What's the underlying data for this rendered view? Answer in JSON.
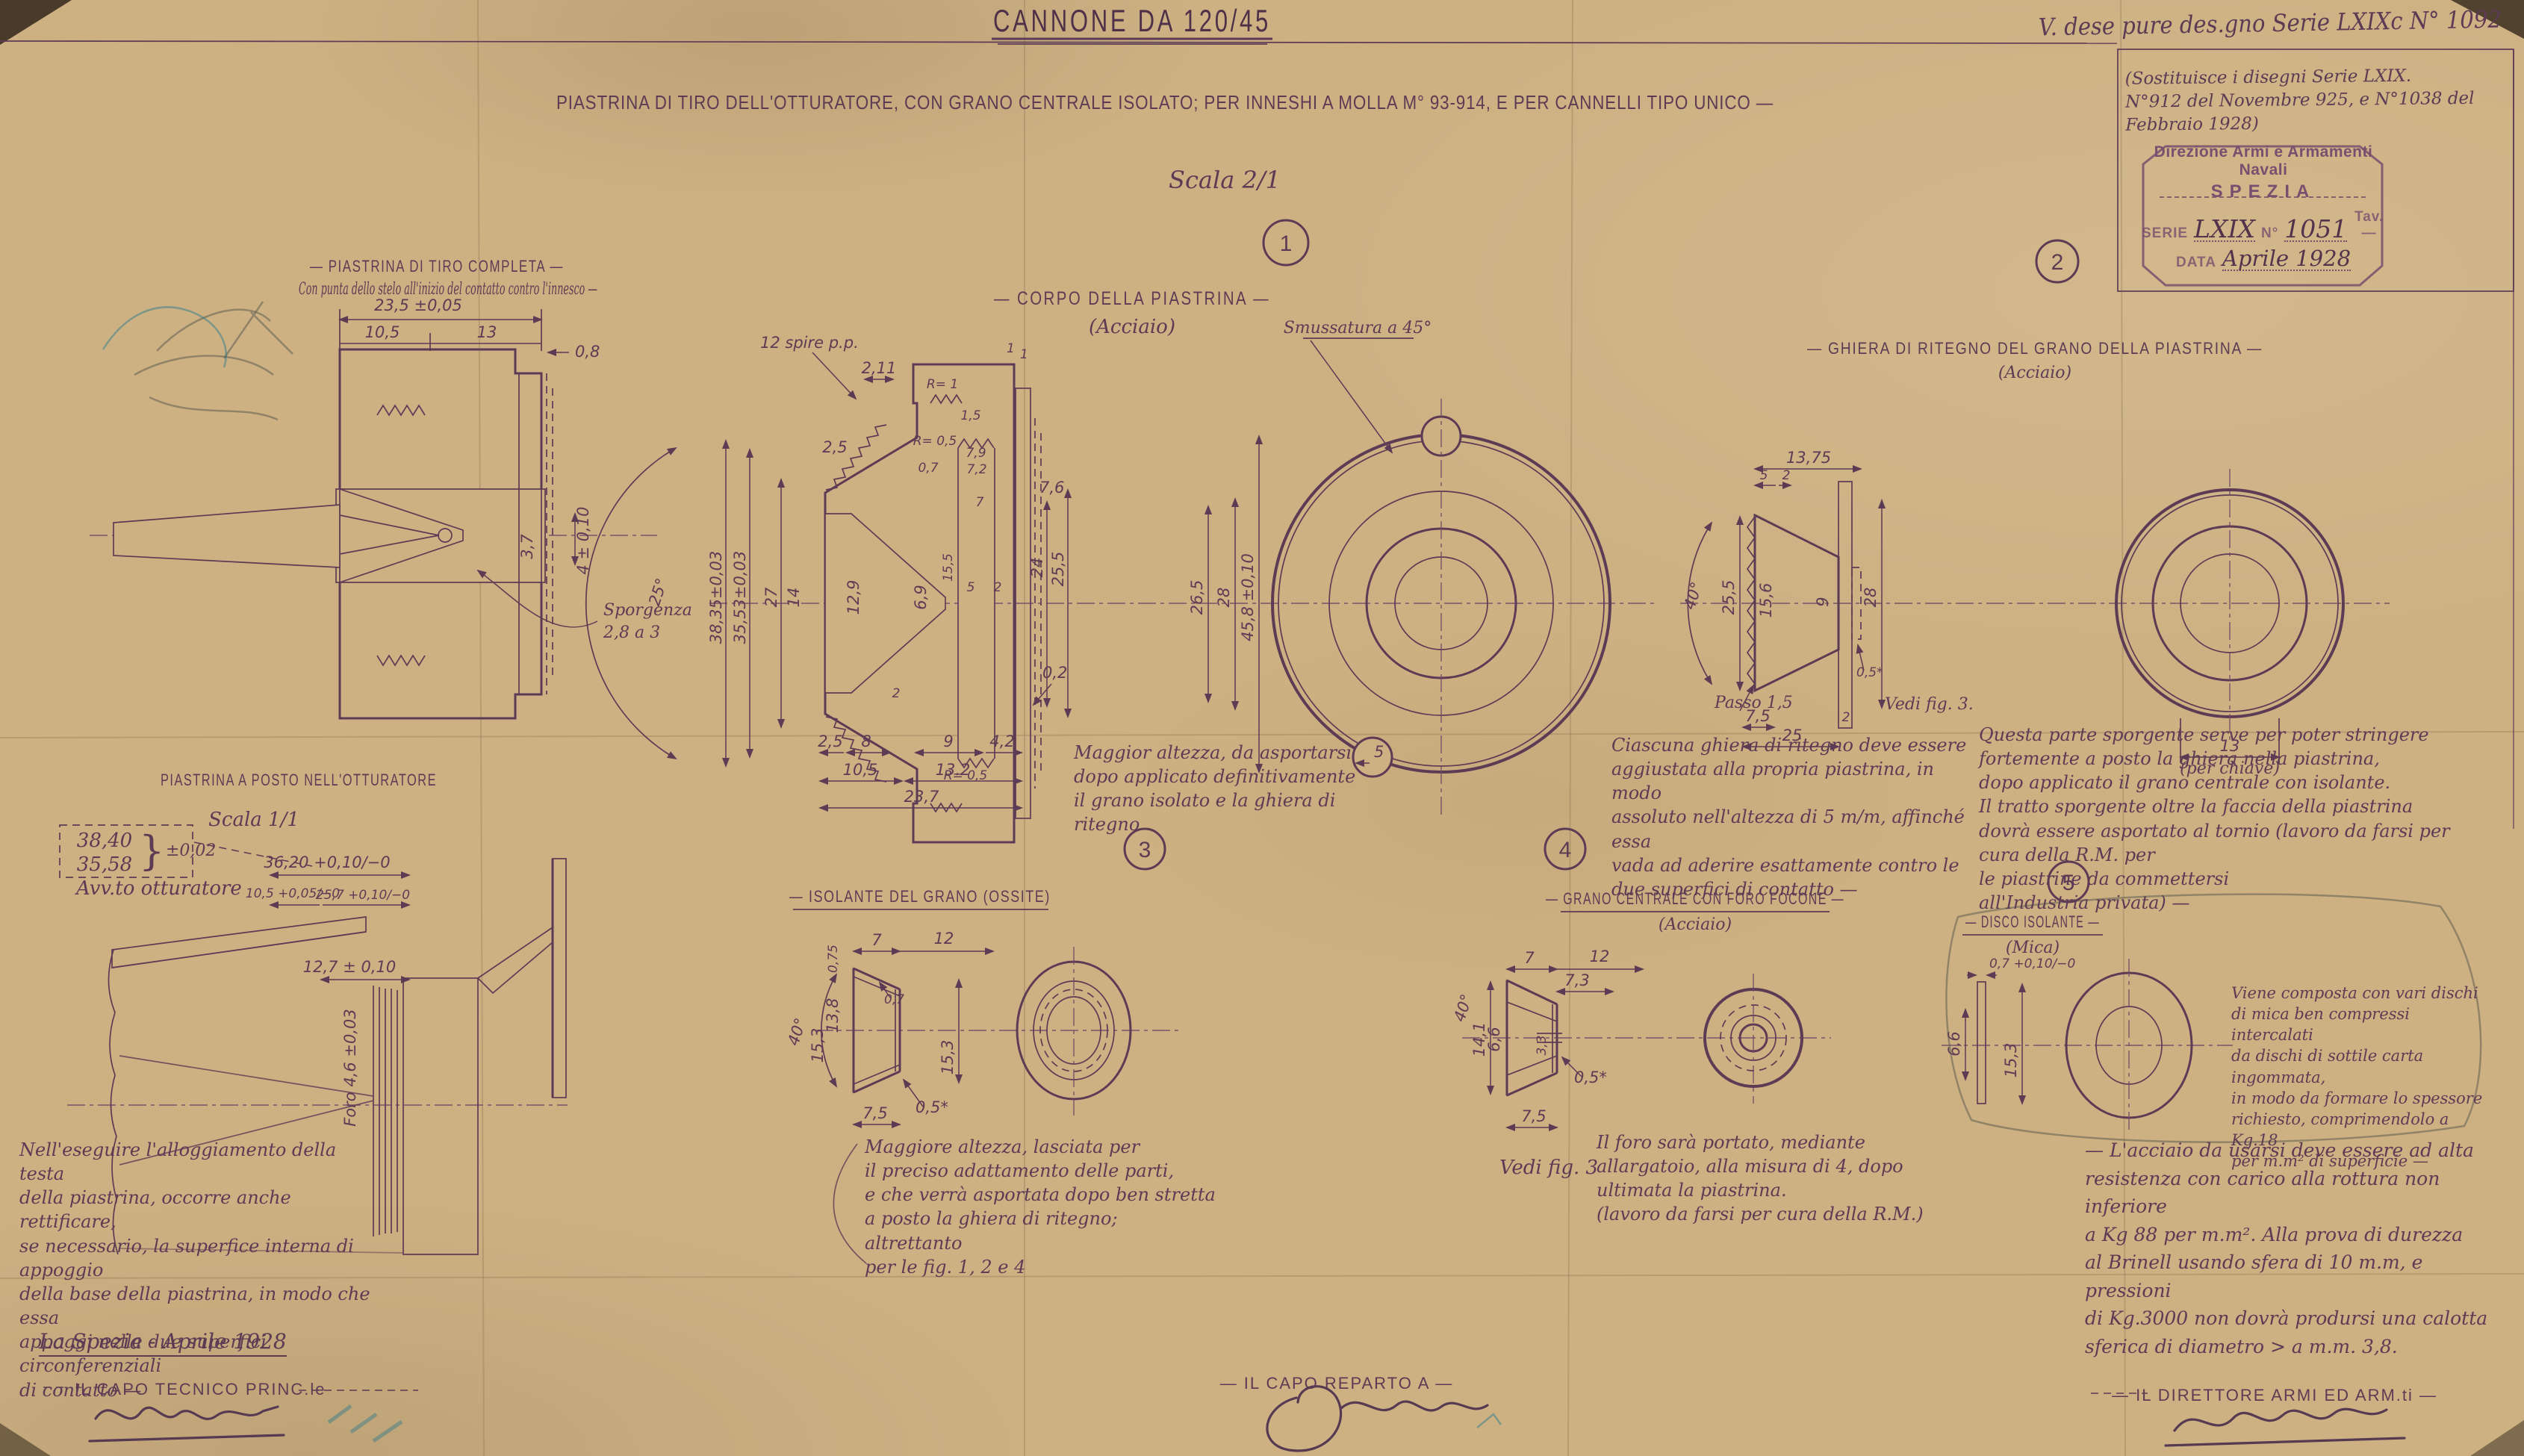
{
  "meta": {
    "title": "CANNONE DA 120/45",
    "subtitle": "PIASTRINA DI TIRO DELL'OTTURATORE, CON GRANO CENTRALE ISOLATO; PER INNESHI A MOLLA M° 93-914, E PER CANNELLI TIPO UNICO —",
    "top_note": "V. dese pure des.gno Serie LXIXc N° 1092",
    "scala": "Scala 2/1",
    "replaces": "(Sostituisce i disegni Serie LXIX.\nN°912 del Novembre 925, e N°1038 del Febbraio 1928)",
    "stamp": {
      "line1": "Direzione Armi e Armamenti Navali",
      "line2": "SPEZIA",
      "serie_label": "SERIE",
      "serie_value": "LXIX",
      "n_label": "N°",
      "n_value": "1051",
      "tav": "Tav.—",
      "data_label": "DATA",
      "data_value": "Aprile 1928"
    }
  },
  "figures": {
    "tiro": {
      "title": "— PIASTRINA DI TIRO COMPLETA —",
      "subnote": "Con punta dello stelo all'inizio del contatto contro l'innesco —",
      "dims": {
        "d235": "23,5 ±0,05",
        "d105": "10,5",
        "d13": "13",
        "d08": "0,8",
        "d37": "3,7",
        "d4": "4 ± 0,10",
        "sporgenza": "Sporgenza",
        "sporgenza2": "2,8 a 3"
      }
    },
    "fig1": {
      "num": "1",
      "title": "— CORPO DELLA PIASTRINA —",
      "mat": "(Acciaio)",
      "smussatura": "Smussatura a 45°",
      "note": "Maggior altezza, da asportarsi\ndopo applicato definitivamente\nil grano isolato e la ghiera di\nritegno",
      "dims": {
        "spire": "12 spire p.p.",
        "d211": "2,11",
        "r1": "R= 1",
        "d1": "1",
        "d15": "1,5",
        "r05a": "R= 0,5",
        "d79": "7,9",
        "d07": "0,7",
        "d72": "7,2",
        "d76": "7,6",
        "d7": "7",
        "d25w": "2,5",
        "d3835": "38,35±0,03",
        "d3553": "35,53±0,03",
        "d27": "27",
        "d14": "14",
        "d129": "12,9",
        "d69": "6,9",
        "d155": "15,5",
        "d24": "24",
        "d255": "25,5",
        "d5": "5",
        "d2": "2",
        "r05b": "R= 0,5",
        "d02": "0,2",
        "d2b": "2",
        "b25": "2,5",
        "b8": "8",
        "b9": "9",
        "b42": "4,2",
        "b105": "10,5",
        "b132": "13.2",
        "b237": "23,7",
        "d5b": "5",
        "d265": "26,5",
        "d28": "28",
        "d458": "45,8 ±0,10",
        "angle25": "25°"
      }
    },
    "fig2": {
      "num": "2",
      "title": "— GHIERA DI RITEGNO DEL GRANO DELLA PIASTRINA —",
      "mat": "(Acciaio)",
      "note_left": "Ciascuna ghiera di ritegno deve essere\naggiustata alla propria piastrina, in modo\nassoluto nell'altezza di 5 m/m, affinché essa\nvada ad aderire esattamente contro le\ndue superfici di contatto —",
      "note_right": "Questa parte sporgente serve per poter stringere\nfortemente a posto la ghiera nella piastrina,\ndopo applicato il grano centrale con isolante.\nIl tratto sporgente oltre la faccia della piastrina\ndovrà essere asportato al tornio (lavoro da farsi per cura della R.M. per\nle piastrine da commettersi\nall'Industria privata) —",
      "dims": {
        "d5": "5",
        "d2": "2",
        "d1375": "13,75",
        "angle": "40°",
        "d255": "25,5",
        "d156": "15,6",
        "d9": "9",
        "d28": "28",
        "passo": "Passo 1,5",
        "d75": "7,5",
        "d25": "25",
        "d2b": "2",
        "d05": "0,5*",
        "vedi": "Vedi fig. 3.",
        "d13": "13",
        "chiave": "(per chiave)"
      }
    },
    "fig3": {
      "num": "3",
      "title": "— ISOLANTE DEL GRANO (OSSITE)",
      "note": "Maggiore altezza, lasciata per\nil preciso adattamento delle parti,\ne che verrà asportata dopo ben stretta\na posto la ghiera di ritegno; altrettanto\nper le fig. 1, 2 e 4",
      "dims": {
        "angle": "40°",
        "d075": "0,75",
        "d7": "7",
        "d12": "12",
        "d07": "0,7",
        "d138": "13,8",
        "d153a": "15,3",
        "d153b": "15,3",
        "d75": "7,5",
        "d05": "0,5*"
      }
    },
    "fig4": {
      "num": "4",
      "title": "— GRANO CENTRALE CON FORO FOCONE —",
      "mat": "(Acciaio)",
      "vedi": "Vedi fig. 3",
      "note": "Il foro sarà portato, mediante\nallargatoio, alla misura di 4, dopo\nultimata la piastrina.\n(lavoro da farsi per cura della R.M.)",
      "dims": {
        "d7": "7",
        "d12": "12",
        "d73": "7,3",
        "d141": "14,1",
        "d66": "6,6",
        "d33": "3,3",
        "d05": "0,5*",
        "d75": "7,5",
        "angle": "40°"
      }
    },
    "fig5": {
      "num": "5",
      "title": "— DISCO ISOLANTE —",
      "mat": "(Mica)",
      "note": "Viene composta con vari dischi\ndi mica ben compressi intercalati\nda dischi di sottile carta ingommata,\nin modo da formare lo spessore\nrichiesto, comprimendolo a Kg.18\nper m.m² di superficie —",
      "dims": {
        "d07": "0,7 +0,10/−0",
        "d66": "6,6",
        "d153": "15,3"
      }
    },
    "otturatore": {
      "title": "PIASTRINA A POSTO NELL'OTTURATORE",
      "scala": "Scala 1/1",
      "d3840": "38,40",
      "d3558": "35,58",
      "tol": "±0,02",
      "brace": "}",
      "avv": "Avv.to otturatore",
      "d3620": "36,20 +0,10/−0",
      "d105": "10,5 +0,05/−0",
      "d257": "25,7 +0,10/−0",
      "d127": "12,7 ± 0,10",
      "foro": "Foro 4,6 ±0,03",
      "note": "Nell'eseguire l'alloggiamento della testa\ndella piastrina, occorre anche rettificare,\nse necessario, la superfice interna di appoggio\ndella base della piastrina, in modo che essa\nappoggi nelle due superfici circonferenziali\ndi contatto —"
    }
  },
  "steel_note": "— L'acciaio da usarsi deve essere ad alta\nresistenza con carico alla rottura non inferiore\na Kg 88 per m.m². Alla prova di durezza\nal Brinell usando sfera di 10 m.m, e pressioni\ndi Kg.3000 non dovrà prodursi una calotta\nsferica di diametro > a m.m. 3,8.",
  "footer": {
    "place_date": "La Spezia - Aprile 1928",
    "sig1": "IL CAPO TECNICO PRINC.le",
    "sig2": "— IL CAPO REPARTO A —",
    "sig3": "— IL DIRETTORE ARMI ED ARM.ti —"
  },
  "colors": {
    "paper": "#cdb183",
    "ink": "#5d3b54",
    "stamp": "#7a4e6e",
    "pencil": "#5f5c50",
    "blue_pencil": "#2e7b8c"
  }
}
